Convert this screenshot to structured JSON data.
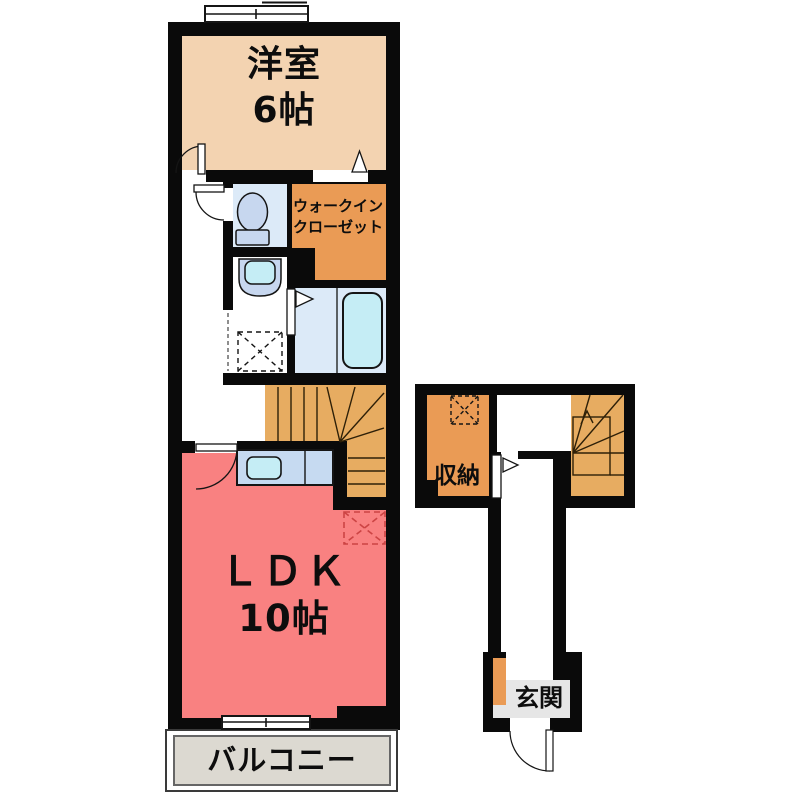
{
  "title": "apartment-floor-plan",
  "colors": {
    "wall": "#0a0a0a",
    "line": "#151515",
    "peach": "#f3d3b1",
    "orange": "#ea9b55",
    "stairs": "#e7ac61",
    "red": "#f98181",
    "room_blue": "#dceaf8",
    "fixture_blue": "#c7d7ef",
    "counter_blue": "#c6daf1",
    "tub_cyan": "#c5edf5",
    "balcony_gray": "#dcd9d1",
    "genkan_gray": "#e6e6e6",
    "fridge_dash": "#cc4444"
  },
  "labels": {
    "western_room_name": "洋室",
    "western_room_size": "6帖",
    "wic_line1": "ウォークイン",
    "wic_line2": "クローゼット",
    "ldk_name": "ＬＤＫ",
    "ldk_size": "10帖",
    "balcony": "バルコニー",
    "storage": "収納",
    "entrance": "玄関"
  }
}
